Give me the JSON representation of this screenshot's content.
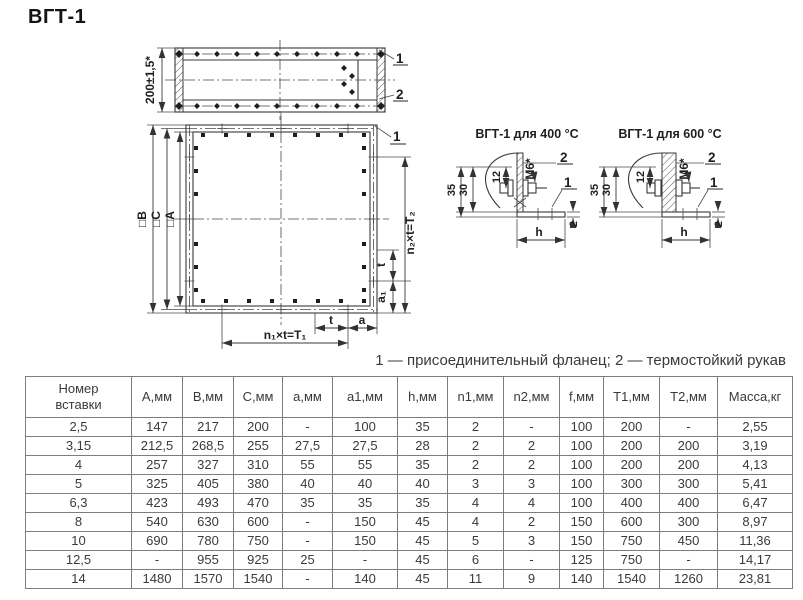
{
  "page": {
    "title": "ВГТ-1"
  },
  "legend": "1 — присоединительный фланец; 2 — термостойкий рукав",
  "colors": {
    "line": "#3a3a3a",
    "text": "#3a3a3a",
    "table_border": "#7d7d7d",
    "background": "#ffffff"
  },
  "drawing": {
    "top_view": {
      "dim_height": "200±1,5*",
      "callout_1": "1",
      "callout_2": "2"
    },
    "front_view": {
      "dim_B": "□B",
      "dim_C": "□C",
      "dim_A": "□A",
      "dim_T2": "n₂×t=T₂",
      "dim_t_side": "t",
      "dim_a1": "a₁",
      "dim_T1": "n₁×t=T₁",
      "dim_t_bottom": "t",
      "dim_a": "a",
      "callout_1": "1"
    },
    "detail_400": {
      "title": "ВГТ-1 для 400 °С",
      "dim_35": "35",
      "dim_30": "30",
      "dim_12": "12",
      "thread": "M6*",
      "callout_2": "2",
      "callout_1": "1",
      "dim_h": "h",
      "dim_2": "2"
    },
    "detail_600": {
      "title": "ВГТ-1 для 600 °С",
      "dim_35": "35",
      "dim_30": "30",
      "dim_12": "12",
      "thread": "M6*",
      "callout_2": "2",
      "callout_1": "1",
      "dim_h": "h",
      "dim_2": "2"
    }
  },
  "table": {
    "headers": [
      "Номер\nвставки",
      "А,мм",
      "В,мм",
      "С,мм",
      "а,мм",
      "а1,мм",
      "h,мм",
      "n1,мм",
      "n2,мм",
      "f,мм",
      "T1,мм",
      "T2,мм",
      "Масса,кг"
    ],
    "rows": [
      [
        "2,5",
        "147",
        "217",
        "200",
        "-",
        "100",
        "35",
        "2",
        "-",
        "100",
        "200",
        "-",
        "2,55"
      ],
      [
        "3,15",
        "212,5",
        "268,5",
        "255",
        "27,5",
        "27,5",
        "28",
        "2",
        "2",
        "100",
        "200",
        "200",
        "3,19"
      ],
      [
        "4",
        "257",
        "327",
        "310",
        "55",
        "55",
        "35",
        "2",
        "2",
        "100",
        "200",
        "200",
        "4,13"
      ],
      [
        "5",
        "325",
        "405",
        "380",
        "40",
        "40",
        "40",
        "3",
        "3",
        "100",
        "300",
        "300",
        "5,41"
      ],
      [
        "6,3",
        "423",
        "493",
        "470",
        "35",
        "35",
        "35",
        "4",
        "4",
        "100",
        "400",
        "400",
        "6,47"
      ],
      [
        "8",
        "540",
        "630",
        "600",
        "-",
        "150",
        "45",
        "4",
        "2",
        "150",
        "600",
        "300",
        "8,97"
      ],
      [
        "10",
        "690",
        "780",
        "750",
        "-",
        "150",
        "45",
        "5",
        "3",
        "150",
        "750",
        "450",
        "11,36"
      ],
      [
        "12,5",
        "-",
        "955",
        "925",
        "25",
        "-",
        "45",
        "6",
        "-",
        "125",
        "750",
        "-",
        "14,17"
      ],
      [
        "14",
        "1480",
        "1570",
        "1540",
        "-",
        "140",
        "45",
        "11",
        "9",
        "140",
        "1540",
        "1260",
        "23,81"
      ]
    ]
  }
}
